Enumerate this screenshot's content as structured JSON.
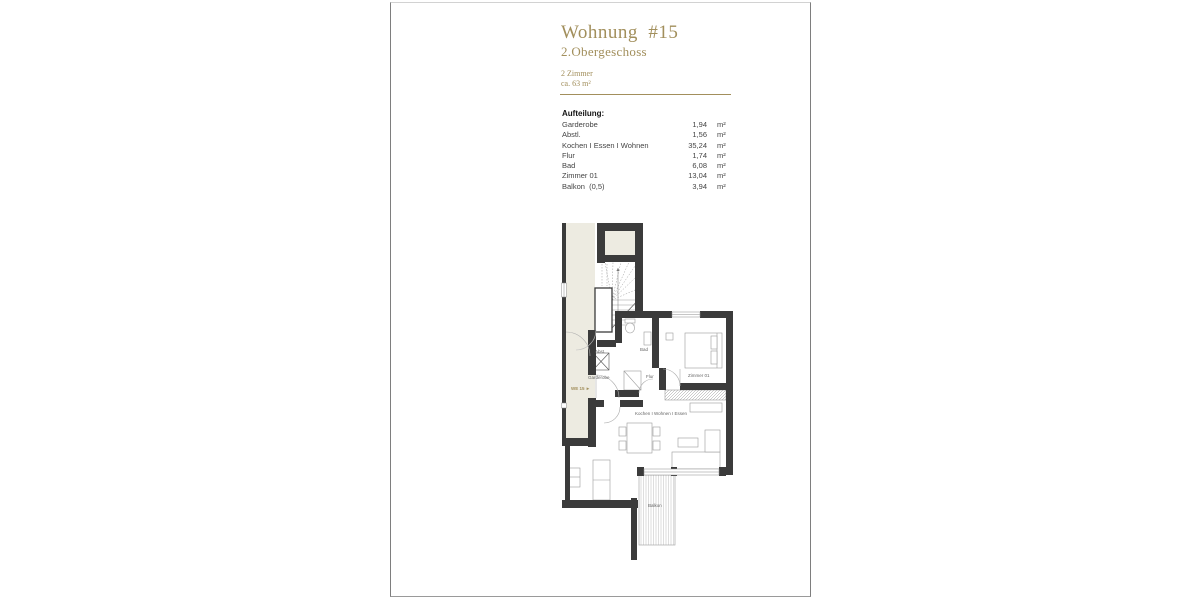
{
  "colors": {
    "accent": "#a28f5c",
    "wall": "#3b3b3b",
    "outside_area": "#edebe1"
  },
  "header": {
    "title": "Wohnung  #15",
    "subtitle": "2.Obergeschoss",
    "rooms": "2 Zimmer",
    "area": "ca. 63 m²"
  },
  "aufteilung": {
    "heading": "Aufteilung:",
    "unit": "m²",
    "rows": [
      {
        "label": "Garderobe",
        "value": "1,94"
      },
      {
        "label": "Abstl.",
        "value": "1,56"
      },
      {
        "label": "Kochen I Essen I Wohnen",
        "value": "35,24"
      },
      {
        "label": "Flur",
        "value": "1,74"
      },
      {
        "label": "Bad",
        "value": "6,08"
      },
      {
        "label": "Zimmer 01",
        "value": "13,04"
      },
      {
        "label": "Balkon  (0,5)",
        "value": "3,94"
      }
    ]
  },
  "plan": {
    "labels": {
      "we": "WE 15 ►",
      "abst": "Abst.",
      "garderobe": "Garderobe",
      "bad": "Bad",
      "flur": "Flur",
      "zimmer": "Zimmer 01",
      "living": "Kochen I Wohnen I Essen",
      "balkon": "Balkon"
    }
  }
}
